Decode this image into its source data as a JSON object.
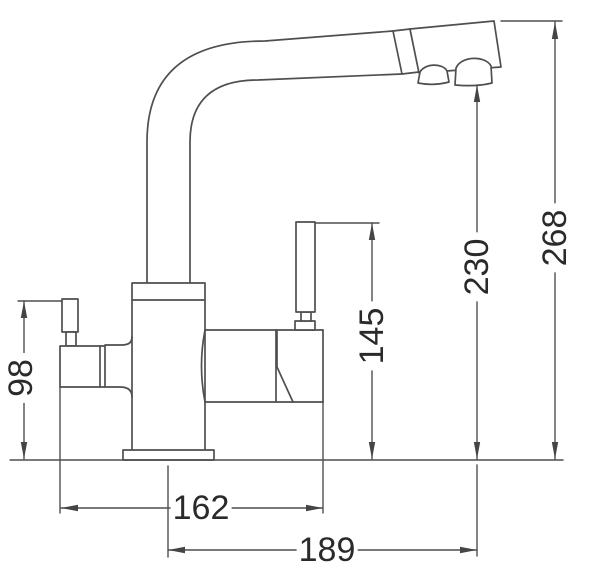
{
  "diagram": {
    "type": "faucet-dimension-drawing",
    "background_color": "#ffffff",
    "line_color": "#4f4f4f",
    "text_color": "#2a2a2a",
    "dimension_labels": {
      "side_knob_height": "98",
      "handle_height": "145",
      "spout_outlet_height": "230",
      "overall_height": "268",
      "body_span_width": "162",
      "spout_reach": "189"
    }
  }
}
